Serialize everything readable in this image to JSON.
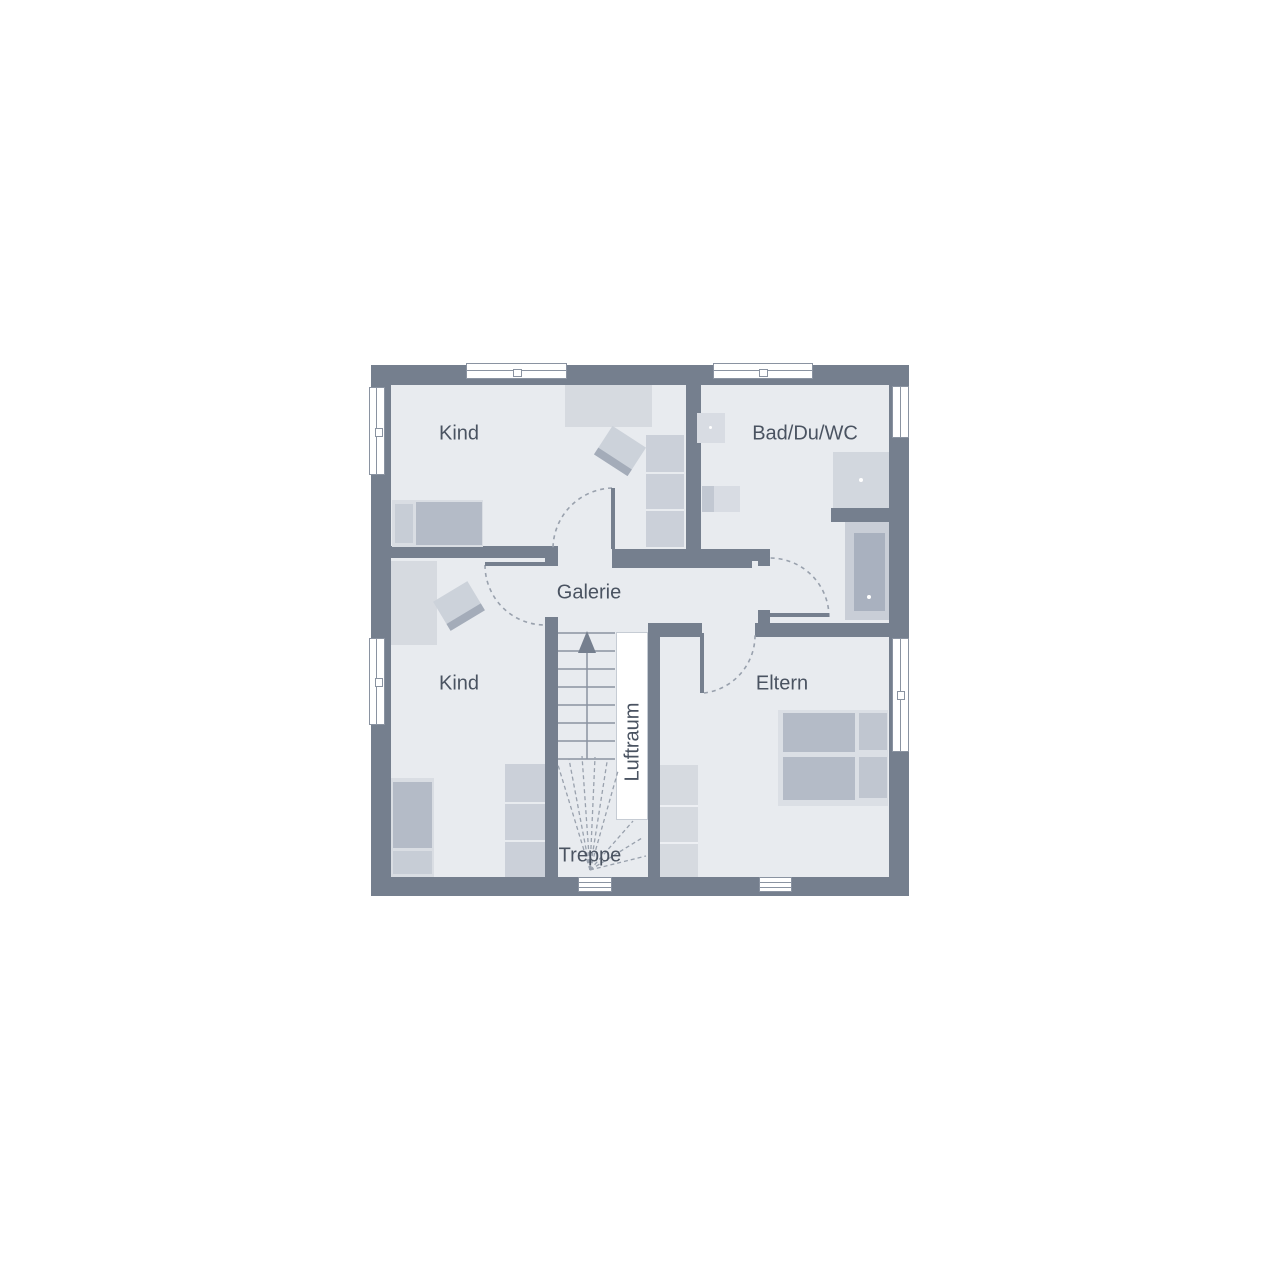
{
  "plan": {
    "title": "Obergeschoss Grundriss",
    "rooms": {
      "kind_top": {
        "label": "Kind"
      },
      "bad": {
        "label": "Bad/Du/WC"
      },
      "galerie": {
        "label": "Galerie"
      },
      "kind_bottom": {
        "label": "Kind"
      },
      "eltern": {
        "label": "Eltern"
      },
      "luftraum": {
        "label": "Luftraum"
      },
      "treppe": {
        "label": "Treppe"
      }
    },
    "colors": {
      "wall": "#757F8E",
      "floor": "#E8EBEF",
      "furniture_light": "#D9DDE3",
      "furniture_medium": "#CBD0D9",
      "furniture_dark": "#B4BBC7",
      "fixture": "#D8DCE3",
      "bathtub": "#A9B1BF",
      "stair_line": "#8A93A1",
      "door_swing_dash": "#99A1AD",
      "label_text": "#4A5361",
      "void_white": "#FFFFFF"
    }
  }
}
